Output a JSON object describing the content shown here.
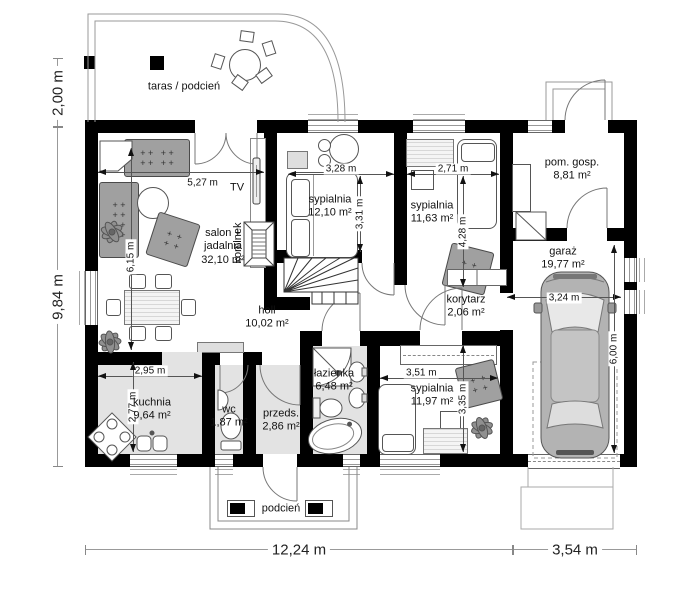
{
  "rooms": {
    "taras": {
      "name": "taras / podcień"
    },
    "salon": {
      "name": "salon + jadalnia",
      "area": "32,10 m²"
    },
    "sypialnia1": {
      "name": "sypialnia",
      "area": "12,10 m²"
    },
    "sypialnia2": {
      "name": "sypialnia",
      "area": "11,63 m²"
    },
    "pom_gosp": {
      "name": "pom. gosp.",
      "area": "8,81 m²"
    },
    "garaz": {
      "name": "garaż",
      "area": "19,77 m²"
    },
    "holl": {
      "name": "holl",
      "area": "10,02 m²"
    },
    "korytarz": {
      "name": "korytarz",
      "area": "2,06 m²"
    },
    "lazienka": {
      "name": "łazienka",
      "area": "6,48 m²"
    },
    "sypialnia3": {
      "name": "sypialnia",
      "area": "11,97 m²"
    },
    "kuchnia": {
      "name": "kuchnia",
      "area": "9,64 m²"
    },
    "wc": {
      "name": "wc",
      "area": "1,87 m²"
    },
    "przedsionek": {
      "name": "przeds.",
      "area": "2,86 m²"
    },
    "podcien": {
      "name": "podcień"
    }
  },
  "fixtures": {
    "tv": "TV",
    "kominek": "kominek"
  },
  "dimensions": {
    "salon_width": "5,27 m",
    "salon_depth": "6,15 m",
    "sypialnia1_width": "3,28 m",
    "sypialnia1_depth": "3,31 m",
    "sypialnia2_width": "2,71 m",
    "sypialnia2_depth": "4,28 m",
    "kuchnia_width": "2,95 m",
    "kuchnia_depth": "2,77 m",
    "sypialnia3_width": "3,51 m",
    "sypialnia3_depth": "3,35 m",
    "garaz_width": "3,24 m",
    "garaz_depth": "6,00 m",
    "taras_depth": "2,00 m",
    "house_depth": "9,84 m",
    "house_width": "12,24 m",
    "garaz_ext_width": "3,54 m"
  },
  "colors": {
    "wall": "#000000",
    "floor": "#e3e3e3",
    "furniture": "#a0a0a0",
    "car_body": "#b3b3b3"
  }
}
